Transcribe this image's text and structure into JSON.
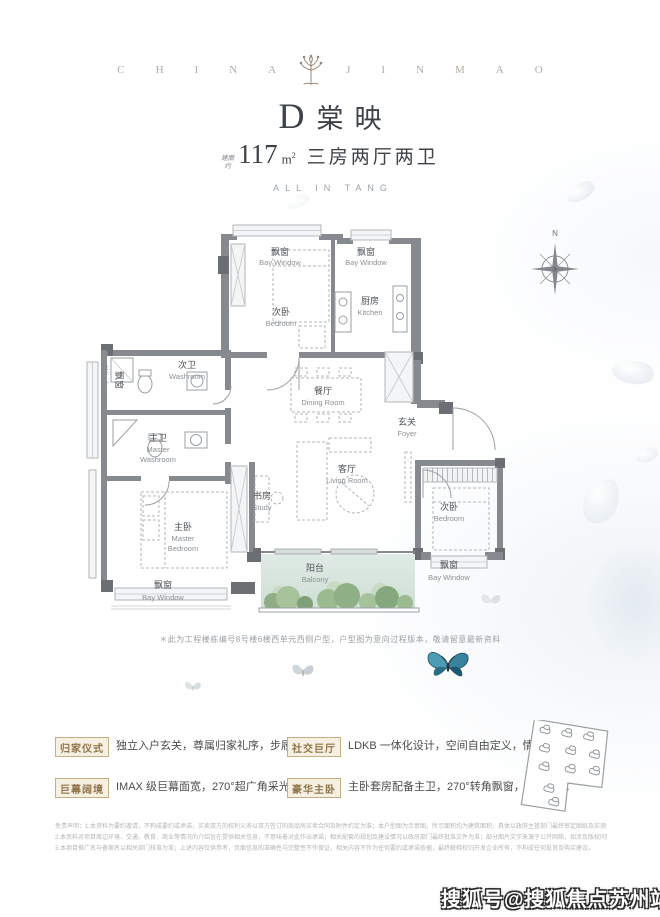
{
  "brand": {
    "left": "CHINA",
    "right": "JINMAO"
  },
  "title": {
    "letter": "D",
    "name": "棠映",
    "area_prefix": [
      "建面",
      "约"
    ],
    "area_value": "117",
    "area_unit_base": "m",
    "area_unit_sup": "2",
    "layout": "三房两厅两卫",
    "slogan": "ALL IN TANG"
  },
  "floorplan": {
    "north_label": "N",
    "note": "＊此为工程楼栋编号8号楼6楼西单元西侧户型，户型图为意向过程版本，敬请留意最新资料",
    "rooms": {
      "bay_window": {
        "cn": "飘窗",
        "en": "Bay Window"
      },
      "bedroom": {
        "cn": "次卧",
        "en": "Bedroom"
      },
      "kitchen": {
        "cn": "厨房",
        "en": "Kitchen"
      },
      "washroom": {
        "cn": "次卫",
        "en": "Washroom"
      },
      "dining": {
        "cn": "餐厅",
        "en": "Dining Room"
      },
      "foyer": {
        "cn": "玄关",
        "en": "Foyer"
      },
      "master_washroom": {
        "cn": "主卫",
        "en1": "Master",
        "en2": "Washroom"
      },
      "living": {
        "cn": "客厅",
        "en": "Living Room"
      },
      "study": {
        "cn": "书房",
        "en": "Study"
      },
      "master_bedroom": {
        "cn": "主卧",
        "en1": "Master",
        "en2": "Bedroom"
      },
      "balcony": {
        "cn": "阳台",
        "en": "Balcony"
      }
    }
  },
  "features": {
    "items": [
      {
        "label": "归家仪式",
        "desc": "独立入户玄关，尊属归家礼序，步履优雅从容"
      },
      {
        "label": "社交巨厅",
        "desc": "LDKB 一体化设计，空间自由定义，情感无界交融"
      },
      {
        "label": "巨幕阔境",
        "desc": "IMAX 级巨幕面宽，270°超广角采光，瞰景"
      },
      {
        "label": "豪华主卧",
        "desc": "主卧套房配备主卫，270°转角飘窗，气派非凡"
      }
    ]
  },
  "legal": {
    "lines": [
      "免责声明：1.本资料为要约邀请，不构成要约或承诺，买卖双方的权利义务以双方签订的商品房买卖合同及附件约定为准；本户型图为示意图，所示面积均为建筑面积，具体以政府主管部门最终审定图纸及实测为准；室内家具、家电、装饰仅为示意，不代表交付标准，交付标准以合同约定为准。",
      "2.本资料对项目周边环境、交通、教育、商业等情况的介绍旨在提供相关信息，不意味着对此作出承诺；相关配套的规划及建设情况以政府部门最终批准文件为准；部分图片文字来源于公开网络，如涉及版权问题请及时联系处理；本资料制作发布时间为2023年，开发商保留修改权利，敬请留意最新资料。",
      "3.本项目推广名与备案名以相关部门核准为准；上述内容仅供参考，页面信息的准确性与完整性不作保证，相关内容不作为任何要约或承诺依据，最终解释权归开发企业所有，不构成任何投资及购买建议。"
    ]
  },
  "watermark": "搜狐号@搜狐焦点苏州站"
}
